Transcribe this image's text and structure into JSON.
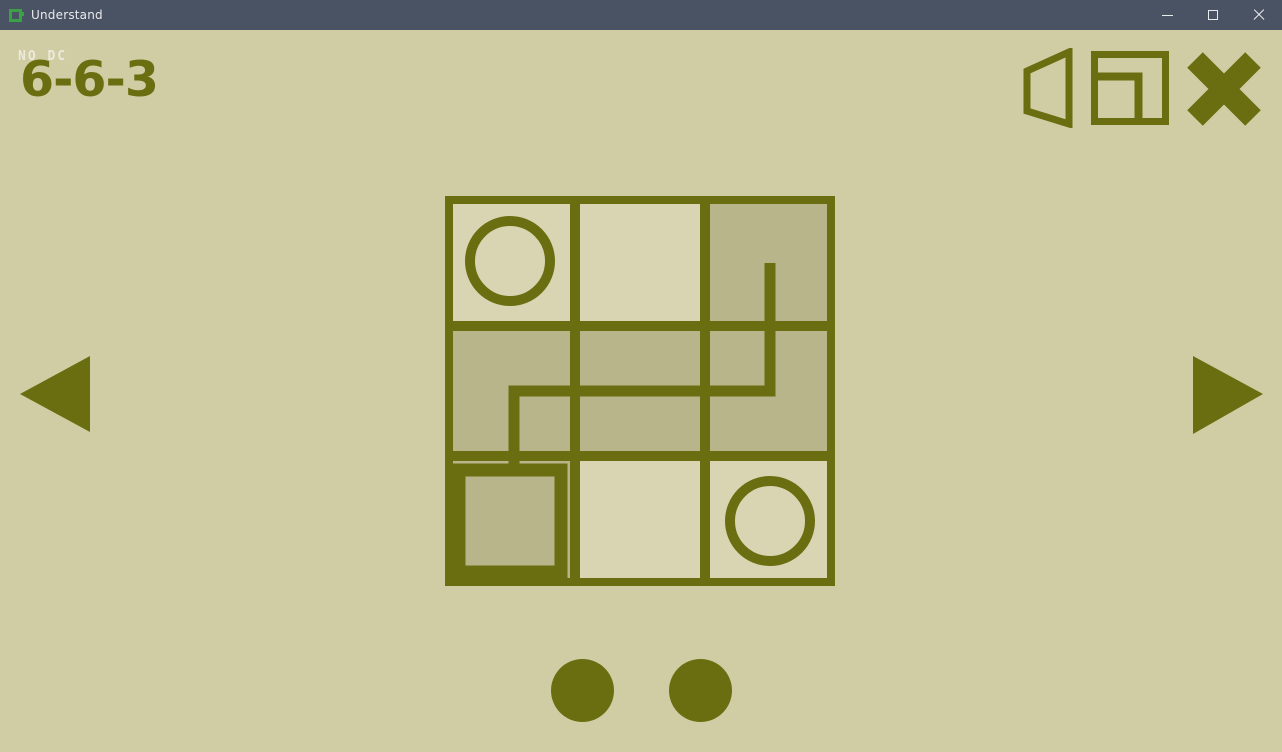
{
  "window": {
    "title": "Understand"
  },
  "hud": {
    "rule_text": "NO DC",
    "level_label": "6-6-3"
  },
  "icons": {
    "titlebar": [
      "app-logo",
      "minimize",
      "maximize",
      "close"
    ],
    "toolbar": [
      "speaker",
      "window-mode",
      "exit-cross"
    ],
    "nav": [
      "prev-arrow",
      "next-arrow"
    ]
  },
  "colors": {
    "background": "#d0cda4",
    "cell_light": "#d9d5b3",
    "cell_shaded": "#b8b58b",
    "olive": "#6b6e10",
    "titlebar": "#4a5363",
    "titlebar_text": "#e9eaec",
    "logo_green": "#3aa245",
    "rule_text_color": "#eceadb"
  },
  "puzzle": {
    "grid_rows": 3,
    "grid_cols": 3,
    "cell_size": 130,
    "shaded_cells": [
      [
        0,
        2
      ],
      [
        1,
        0
      ],
      [
        1,
        1
      ],
      [
        1,
        2
      ],
      [
        2,
        0
      ]
    ],
    "symbols": [
      {
        "type": "circle",
        "cell": [
          0,
          0
        ]
      },
      {
        "type": "circle",
        "cell": [
          2,
          2
        ]
      },
      {
        "type": "square",
        "cell": [
          2,
          0
        ]
      }
    ],
    "path_points": [
      [
        325,
        67
      ],
      [
        325,
        195
      ],
      [
        69,
        195
      ],
      [
        69,
        273
      ]
    ]
  },
  "pagination": {
    "dot_count": 2
  }
}
